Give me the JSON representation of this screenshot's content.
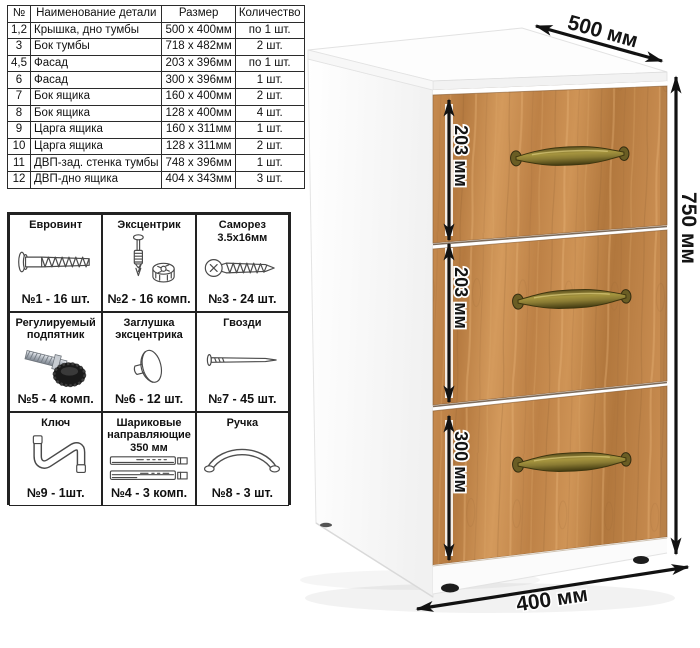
{
  "parts_table": {
    "headers": [
      "№",
      "Наименование детали",
      "Размер",
      "Количество"
    ],
    "rows": [
      [
        "1,2",
        "Крышка, дно тумбы",
        "500 x 400мм",
        "по 1 шт."
      ],
      [
        "3",
        "Бок тумбы",
        "718 x 482мм",
        "2 шт."
      ],
      [
        "4,5",
        "Фасад",
        "203 x 396мм",
        "по 1 шт."
      ],
      [
        "6",
        "Фасад",
        "300 x 396мм",
        "1 шт."
      ],
      [
        "7",
        "Бок ящика",
        "160 x 400мм",
        "2 шт."
      ],
      [
        "8",
        "Бок ящика",
        "128 x 400мм",
        "4 шт."
      ],
      [
        "9",
        "Царга ящика",
        "160 x 311мм",
        "1 шт."
      ],
      [
        "10",
        "Царга ящика",
        "128 x 311мм",
        "2 шт."
      ],
      [
        "11",
        "ДВП-зад. стенка тумбы",
        "748 x 396мм",
        "1 шт."
      ],
      [
        "12",
        "ДВП-дно ящика",
        "404 x 343мм",
        "3 шт."
      ]
    ]
  },
  "hardware_grid": {
    "items": [
      {
        "title": "Евровинт",
        "count": "№1 - 16 шт."
      },
      {
        "title": "Эксцентрик",
        "count": "№2 - 16 комп."
      },
      {
        "title": "Саморез 3.5х16мм",
        "count": "№3 - 24 шт."
      },
      {
        "title": "Регулируемый подпятник",
        "count": "№5 - 4 комп."
      },
      {
        "title": "Заглушка эксцентрика",
        "count": "№6 - 12 шт."
      },
      {
        "title": "Гвозди",
        "count": "№7 - 45 шт."
      },
      {
        "title": "Ключ",
        "count": "№9 - 1шт."
      },
      {
        "title": "Шариковые направляющие 350 мм",
        "count": "№4 - 3 комп."
      },
      {
        "title": "Ручка",
        "count": "№8 - 3 шт."
      }
    ]
  },
  "cabinet": {
    "dimensions": {
      "depth": "500 мм",
      "height": "750 мм",
      "width": "400 мм",
      "drawer1": "203 мм",
      "drawer2": "203 мм",
      "drawer3": "300 мм"
    },
    "colors": {
      "wood": "#c28449",
      "handle_bronze": "#8a7b33",
      "body_white": "#ffffff",
      "dimension_black": "#121212"
    }
  }
}
